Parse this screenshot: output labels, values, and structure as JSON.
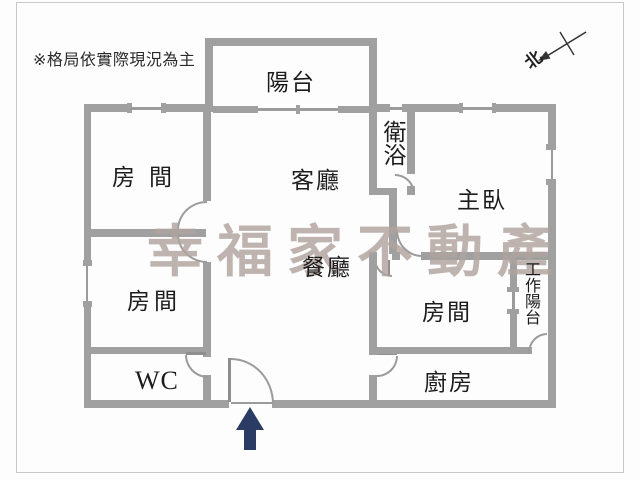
{
  "disclaimer": "※格局依實際現況為主",
  "watermark": "幸福家不動產",
  "compass": {
    "north_label": "北"
  },
  "rooms": {
    "balcony": "陽台",
    "room_top_left": "房間",
    "living": "客廳",
    "bathroom": "衛浴",
    "master": "主臥",
    "dining": "餐廳",
    "room_bottom_left": "房間",
    "room_bottom_right": "房間",
    "work_balcony": "工作陽台",
    "kitchen": "廚房",
    "wc": "WC"
  },
  "colors": {
    "wall": "#a0a0a0",
    "watermark": "#b1a49e",
    "entry_arrow": "#2a3c63",
    "label": "#1c1c1c",
    "frame": "#c9c9c9"
  }
}
